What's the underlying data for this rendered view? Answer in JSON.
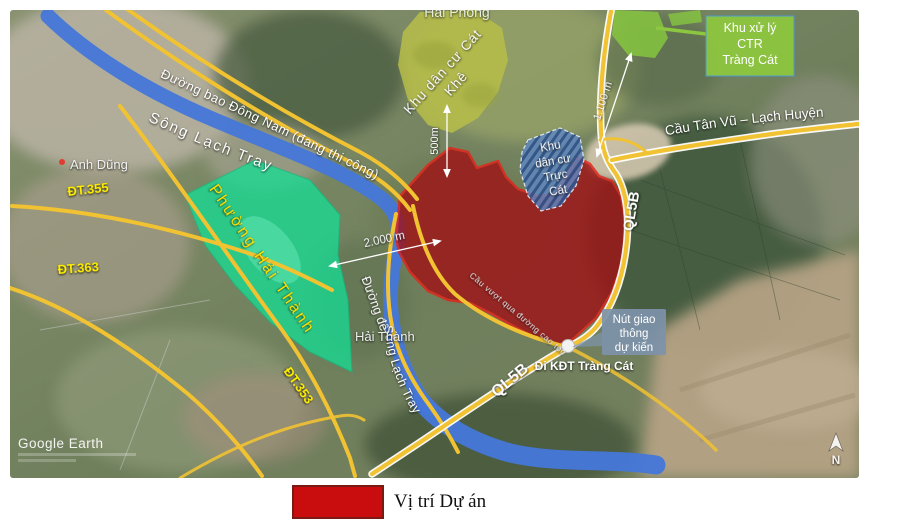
{
  "legend": {
    "label": "Vị trí Dự án",
    "swatch_color": "#c90d0e"
  },
  "map": {
    "watermark": "Google Earth",
    "compass": "N",
    "places": {
      "hai_phong": "Hải Phòng",
      "anh_dung": "Anh Dũng",
      "hai_thanh": "Hải Thành"
    },
    "areas": {
      "cat_khe_line1": "Khu dân cư Cát",
      "cat_khe_line2": "Khê",
      "phuong_hai_thanh": "Phường Hải Thành",
      "truc_cat_lines": [
        "Khu",
        "dân cư",
        "Trực",
        "Cát"
      ],
      "landfill_box_lines": [
        "Khu xử lý",
        "CTR",
        "Tràng Cát"
      ]
    },
    "roads": {
      "duong_bao": "Đường bao Đông Nam (đang thi công)",
      "song_lach_tray_upper": "Sông Lạch Tray",
      "song_lach_tray_lower": "Sông Lạch Tray",
      "cau_tan_vu": "Cầu Tân Vũ – Lạch Huyện",
      "dt355": "ĐT.355",
      "dt363": "ĐT.363",
      "dt353": "ĐT.353",
      "ql5b_upper": "QL5B",
      "ql5b_lower": "QL5B",
      "duong_de": "Đường đê",
      "cau_vuot": "Cầu vượt qua đường cao tốc",
      "di_kdt": "Đi KĐT Tràng Cát"
    },
    "annotations": {
      "nut_giao_lines": [
        "Nút giao",
        "thông",
        "dự kiến"
      ],
      "dist_500": "500m",
      "dist_1100": "1.100 m",
      "dist_2000": "2.000 m"
    },
    "colors": {
      "project_fill": "#a01115",
      "project_border": "#e62117",
      "ward_green": "#12e096",
      "residential_olive": "#b8bf49",
      "landfill_green": "#8dc63f",
      "planned_blue": "#6a93c8",
      "road_yellow": "#f1c232",
      "river_blue": "#4577d9",
      "callout_slate": "#7e93aa"
    }
  }
}
